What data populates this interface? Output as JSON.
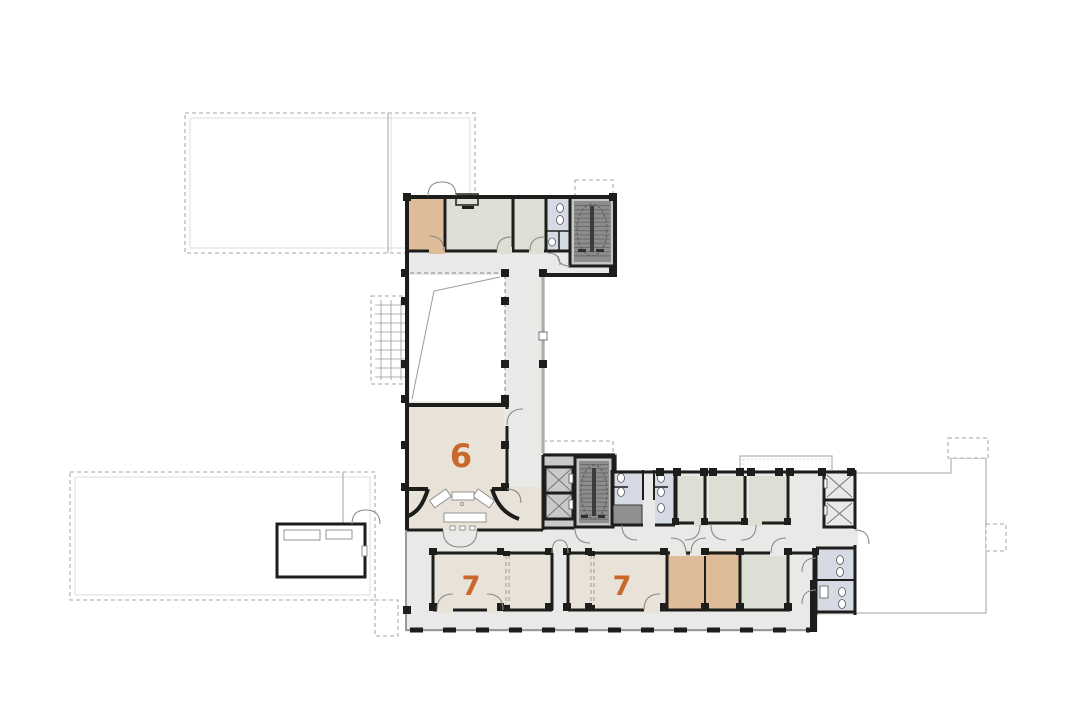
{
  "floor_plan": {
    "room_labels": [
      {
        "id": "room-6",
        "label": "6"
      },
      {
        "id": "room-7-west",
        "label": "7"
      },
      {
        "id": "room-7-east",
        "label": "7"
      }
    ],
    "colors": {
      "wall": "#1d1d1b",
      "corridor": "#e9e9e7",
      "room_beige": "#e8e2d9",
      "room_tan": "#debc9a",
      "room_green": "#dce0d4",
      "room_blue": "#d6dae4",
      "stair_dark": "#8d8d8c",
      "stair_light": "#c6c6c5",
      "service_gray": "#8f8f8f",
      "outline_gray": "#b6b6b3",
      "line_gray": "#9a9a98",
      "label_orange": "#c8682a",
      "background": "#ffffff"
    }
  }
}
